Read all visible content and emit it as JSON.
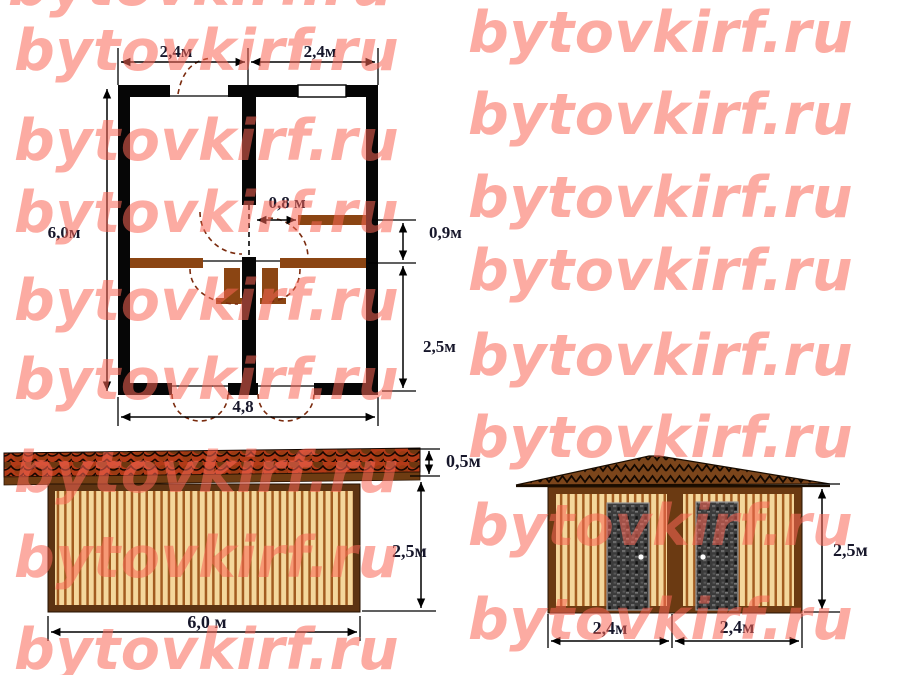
{
  "watermark": {
    "text": "bytovkirf.ru",
    "color_rgba": "rgba(249,102,86,0.55)"
  },
  "floor_plan": {
    "labels": {
      "width_left": "2,4м",
      "width_right": "2,4м",
      "height": "6,0м",
      "door_width": "0,8 м",
      "corridor_depth": "0,9м",
      "room_depth": "2,5м",
      "inner_width": "4,8"
    }
  },
  "side_elevation": {
    "labels": {
      "roof_height": "0,5м",
      "wall_height": "2,5м",
      "length": "6,0 м"
    }
  },
  "front_elevation": {
    "labels": {
      "wall_height": "2,5м",
      "bay_left": "2,4м",
      "bay_right": "2,4м"
    }
  },
  "colors": {
    "wall": "#060606",
    "partition": "#8B4513",
    "roof_side_base": "#B23A17",
    "roof_front": "#7B451B",
    "plank_light": "#F4D79C",
    "plank_dark": "#A25C20",
    "frame_brown": "#5C3312",
    "door_gray": "#3B3B3B",
    "watermark_salmon": "#FBAEA4"
  }
}
